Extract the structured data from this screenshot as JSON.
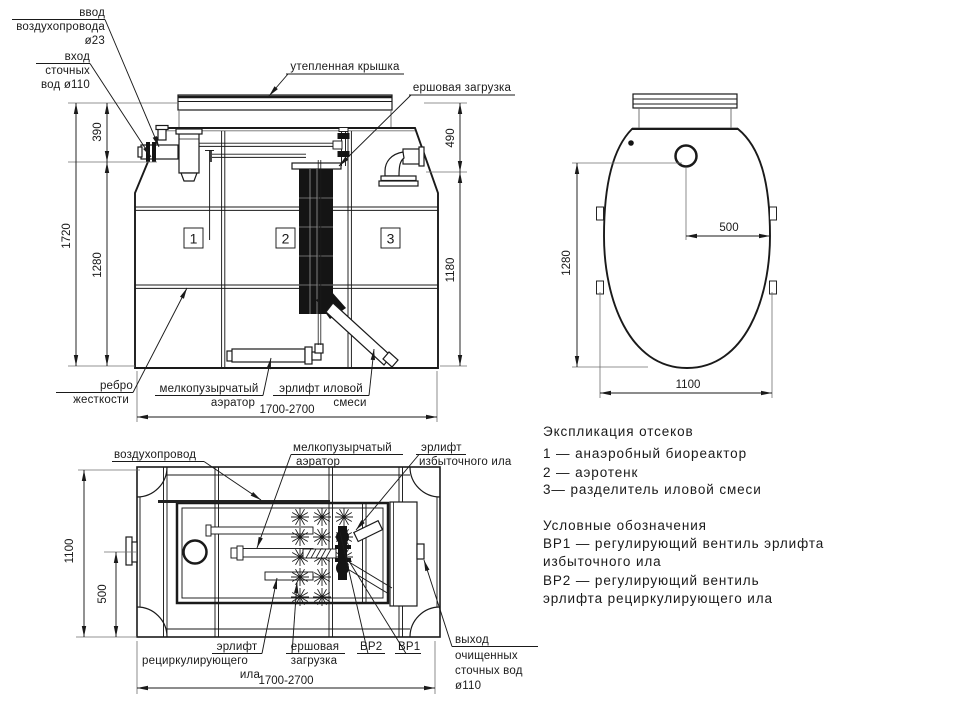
{
  "front": {
    "labels": {
      "air_inlet": [
        "ввод",
        "воздухопровода",
        "ø23"
      ],
      "sewage_inlet": [
        "вход",
        "сточных",
        "вод ø110"
      ],
      "cover": "утепленная  крышка",
      "brush": "ершовая  загрузка",
      "rib": [
        "ребро",
        "жесткости"
      ],
      "aerator": [
        "мелкопузырчатый",
        "аэратор"
      ],
      "sludge_airlift": [
        "эрлифт  иловой",
        "смеси"
      ]
    },
    "dims": {
      "total_height": "1720",
      "body_height": "1280",
      "top_height": "390",
      "right_top": "490",
      "right_body": "1180",
      "width": "1700-2700"
    },
    "compartments": [
      "1",
      "2",
      "3"
    ]
  },
  "top_view": {
    "dims": {
      "height": "1280",
      "offset": "500",
      "width": "1100"
    }
  },
  "plan": {
    "labels": {
      "air_duct": "воздухопровод",
      "aerator": [
        "мелкопузырчатый",
        "аэратор"
      ],
      "excess_airlift": [
        "эрлифт",
        "избыточного  ила"
      ],
      "recirc_airlift": [
        "эрлифт",
        "рециркулирующего",
        "ила"
      ],
      "brush": [
        "ершовая",
        "загрузка"
      ],
      "vr2": "ВР2",
      "vr1": "ВР1",
      "outlet": [
        "выход",
        "очищенных",
        "сточных  вод",
        "ø110"
      ]
    },
    "dims": {
      "height": "1100",
      "offset": "500",
      "width": "1700-2700"
    }
  },
  "legend": {
    "sections_title": "Экспликация  отсеков",
    "sections": [
      "1  —   анаэробный  биореактор",
      "2  —   аэротенк",
      "3—  разделитель  иловой  смеси"
    ],
    "symbols_title": "Условные  обозначения",
    "symbols": [
      "ВР1  —   регулирующий  вентиль  эрлифта",
      "избыточного  ила",
      "ВР2  —   регулирующий  вентиль",
      "эрлифта  рециркулирующего  ила"
    ]
  }
}
